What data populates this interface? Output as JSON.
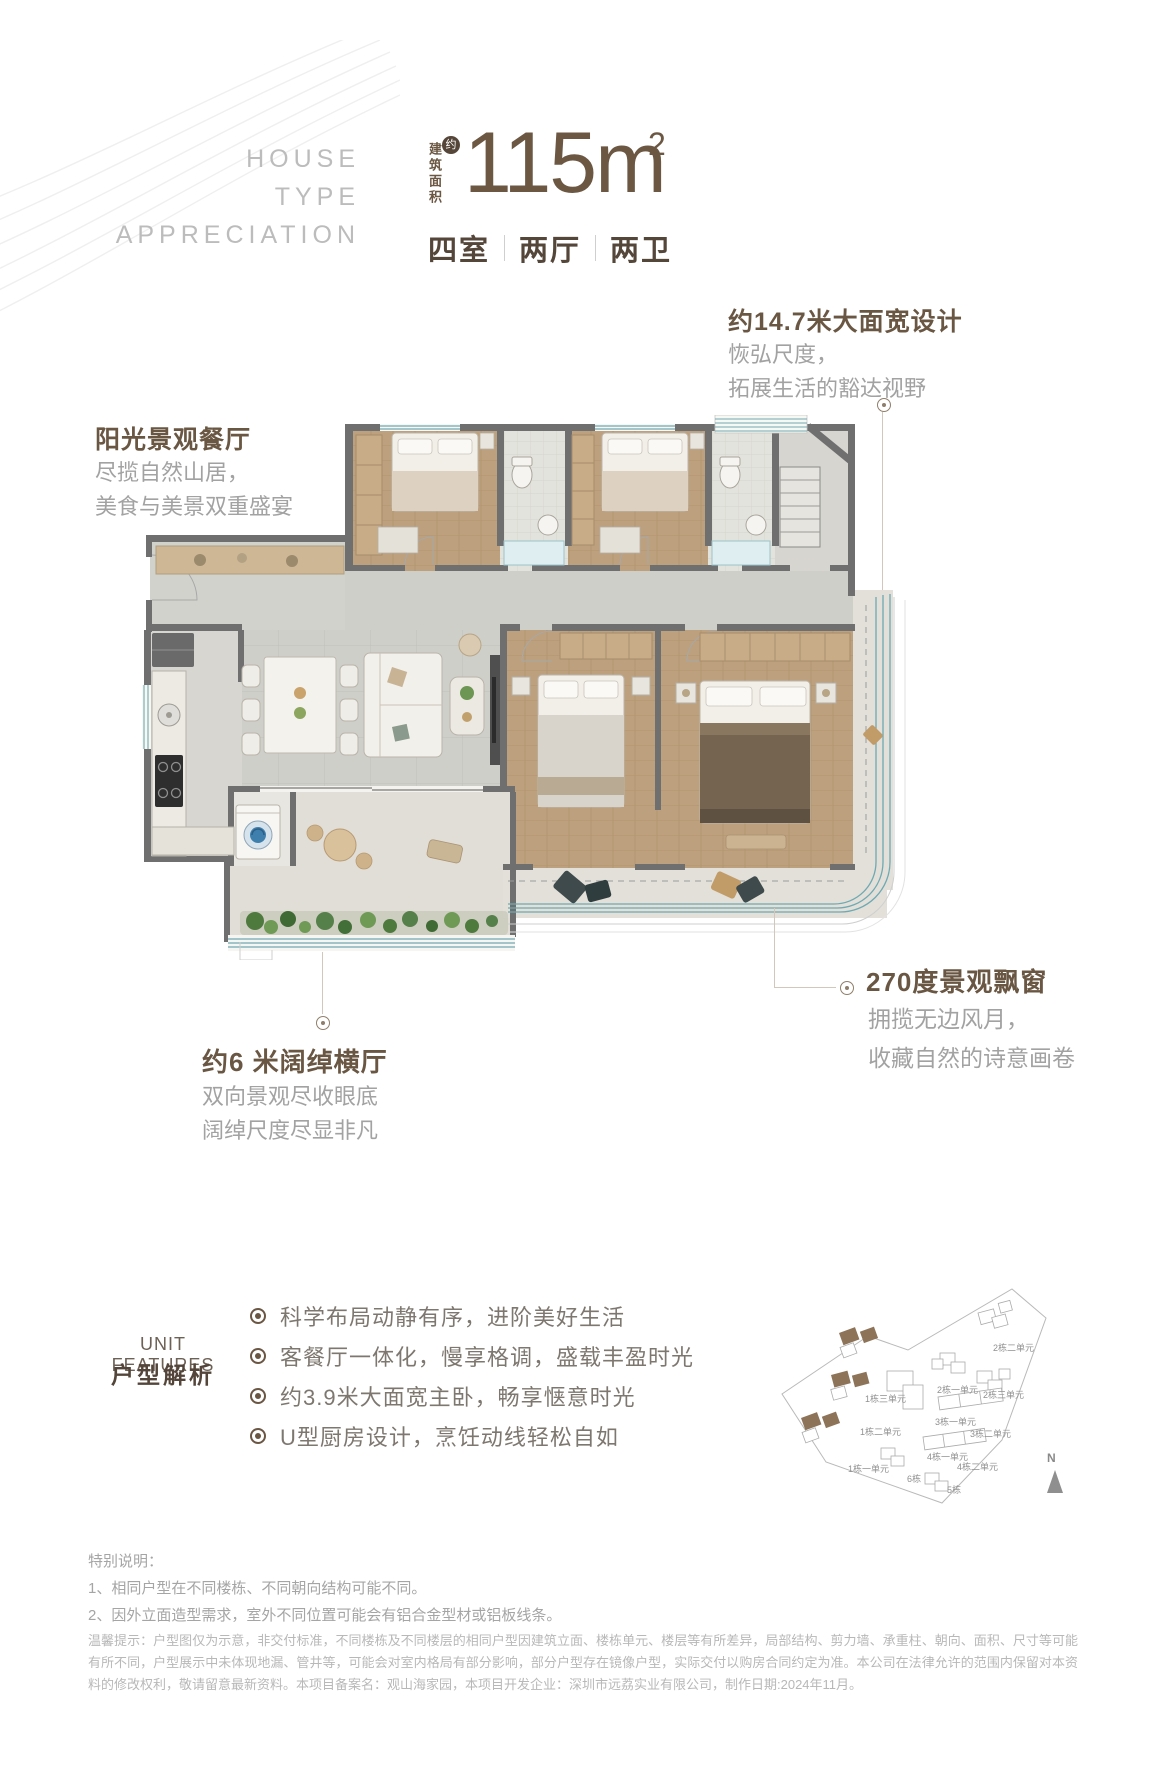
{
  "header": {
    "watermark": [
      "HOUSE",
      "TYPE",
      "APPRECIATION"
    ],
    "area_label_vertical": "建筑面积",
    "approx_badge": "约",
    "area_number": "115m",
    "area_exponent": "2",
    "rooms": [
      "四室",
      "两厅",
      "两卫"
    ]
  },
  "annotations": {
    "dining": {
      "title": "阳光景观餐厅",
      "line1": "尽揽自然山居，",
      "line2": "美食与美景双重盛宴"
    },
    "facade": {
      "title": "约14.7米大面宽设计",
      "line1": "恢弘尺度，",
      "line2": "拓展生活的豁达视野"
    },
    "bay": {
      "title": "270度景观飘窗",
      "line1": "拥揽无边风月，",
      "line2": "收藏自然的诗意画卷"
    },
    "hall": {
      "title": "约6 米阔绰横厅",
      "line1": "双向景观尽收眼底",
      "line2": "阔绰尺度尽显非凡"
    }
  },
  "features": {
    "label_en": "UNIT FEATURES",
    "label_zh": "户型解析",
    "items": [
      "科学布局动静有序，进阶美好生活",
      "客餐厅一体化，慢享格调，盛载丰盈时光",
      "约3.9米大面宽主卧，畅享惬意时光",
      "U型厨房设计，烹饪动线轻松自如"
    ]
  },
  "sitemap": {
    "labels": [
      "2栋二单元",
      "2栋一单元",
      "2栋三单元",
      "1栋三单元",
      "3栋一单元",
      "3栋二单元",
      "1栋二单元",
      "4栋一单元",
      "4栋二单元",
      "1栋一单元",
      "6栋",
      "5栋"
    ],
    "north": "N",
    "highlight_color": "#8d7358"
  },
  "notes": {
    "special_title": "特别说明：",
    "special_1": "1、相同户型在不同楼栋、不同朝向结构可能不同。",
    "special_2": "2、因外立面造型需求，室外不同位置可能会有铝合金型材或铝板线条。",
    "legal": "温馨提示：户型图仅为示意，非交付标准，不同楼栋及不同楼层的相同户型因建筑立面、楼栋单元、楼层等有所差异，局部结构、剪力墙、承重柱、朝向、面积、尺寸等可能有所不同，户型展示中未体现地漏、管井等，可能会对室内格局有部分影响，部分户型存在镜像户型，实际交付以购房合同约定为准。本公司在法律允许的范围内保留对本资料的修改权利，敬请留意最新资料。本项目备案名：观山海家园，本项目开发企业：深圳市远荔实业有限公司，制作日期:2024年11月。"
  },
  "colors": {
    "brand_brown": "#6b5742",
    "title_brown": "#6a5743",
    "text_gray": "#a2a2a2",
    "wall_gray": "#6f6f6f",
    "window_teal": "#6fa9b2",
    "highlight_brown": "#8d7358"
  }
}
